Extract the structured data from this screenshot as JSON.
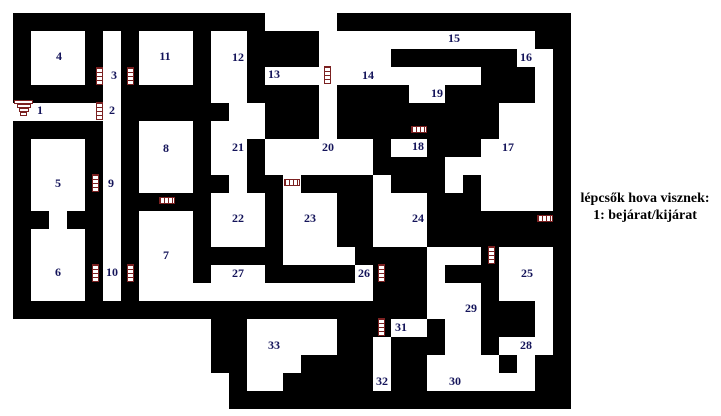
{
  "map": {
    "grid": {
      "origin_x": 13,
      "origin_y": 13,
      "cell": 18,
      "cols": 31,
      "rows": 22
    },
    "wall_color": "#000000",
    "floor_color": "#ffffff",
    "wall_rows": [
      "##############....#############",
      "#...#.#...#..####............##",
      "#...#.#...#..####....#######..#",
      "#...#.#...#..#............###.#",
      "#####.#####..####.####..#####.#",
      "......######..###.#########...#",
      "#####.#...#...###.#########...#",
      "#...#.#...#..#......#..###....#",
      "#...#.#...#..#......####......#",
      "#...#.#...##.##.####.###.#....#",
      "#...#.#####...#...##...###....#",
      "##.##.#...#...#...##...########",
      "#...#.#...#...#...##...########",
      "#...#.#...#####....####...#...#",
      "#...#.#...#...#####.###.###...#",
      "#...#.#.............###...#...#",
      "#######################...###.#",
      "...........##.....###..#..###.#",
      "...........##.....##.###..#...#",
      "...........##...####.##....#.##",
      "............#..#####.##......##",
      "............###################"
    ]
  },
  "label_color": "#14145a",
  "rooms": [
    {
      "label": "1",
      "x": 40,
      "y": 110
    },
    {
      "label": "2",
      "x": 112,
      "y": 110
    },
    {
      "label": "3",
      "x": 114,
      "y": 75
    },
    {
      "label": "4",
      "x": 59,
      "y": 56
    },
    {
      "label": "5",
      "x": 58,
      "y": 183
    },
    {
      "label": "6",
      "x": 58,
      "y": 272
    },
    {
      "label": "7",
      "x": 166,
      "y": 255
    },
    {
      "label": "8",
      "x": 166,
      "y": 148
    },
    {
      "label": "9",
      "x": 111,
      "y": 183
    },
    {
      "label": "10",
      "x": 112,
      "y": 272
    },
    {
      "label": "11",
      "x": 165,
      "y": 56
    },
    {
      "label": "12",
      "x": 238,
      "y": 57
    },
    {
      "label": "13",
      "x": 274,
      "y": 74
    },
    {
      "label": "14",
      "x": 368,
      "y": 75
    },
    {
      "label": "15",
      "x": 454,
      "y": 38
    },
    {
      "label": "16",
      "x": 526,
      "y": 57
    },
    {
      "label": "17",
      "x": 508,
      "y": 147
    },
    {
      "label": "18",
      "x": 418,
      "y": 146
    },
    {
      "label": "19",
      "x": 437,
      "y": 93
    },
    {
      "label": "20",
      "x": 328,
      "y": 147
    },
    {
      "label": "21",
      "x": 238,
      "y": 147
    },
    {
      "label": "22",
      "x": 238,
      "y": 218
    },
    {
      "label": "23",
      "x": 310,
      "y": 218
    },
    {
      "label": "24",
      "x": 418,
      "y": 218
    },
    {
      "label": "25",
      "x": 527,
      "y": 273
    },
    {
      "label": "26",
      "x": 364,
      "y": 273
    },
    {
      "label": "27",
      "x": 238,
      "y": 273
    },
    {
      "label": "28",
      "x": 526,
      "y": 345
    },
    {
      "label": "29",
      "x": 471,
      "y": 308
    },
    {
      "label": "30",
      "x": 455,
      "y": 381
    },
    {
      "label": "31",
      "x": 401,
      "y": 327
    },
    {
      "label": "32",
      "x": 382,
      "y": 381
    },
    {
      "label": "33",
      "x": 274,
      "y": 345
    }
  ],
  "stairs": {
    "color": "#7b2121",
    "ladders": [
      {
        "x": 96,
        "y": 67,
        "dir": "v"
      },
      {
        "x": 127,
        "y": 67,
        "dir": "v"
      },
      {
        "x": 96,
        "y": 102,
        "dir": "v"
      },
      {
        "x": 92,
        "y": 174,
        "dir": "v"
      },
      {
        "x": 92,
        "y": 264,
        "dir": "v"
      },
      {
        "x": 127,
        "y": 264,
        "dir": "v"
      },
      {
        "x": 324,
        "y": 66,
        "dir": "v"
      },
      {
        "x": 488,
        "y": 246,
        "dir": "v"
      },
      {
        "x": 378,
        "y": 264,
        "dir": "v"
      },
      {
        "x": 378,
        "y": 318,
        "dir": "v"
      },
      {
        "x": 159,
        "y": 197,
        "dir": "h"
      },
      {
        "x": 284,
        "y": 179,
        "dir": "h"
      },
      {
        "x": 411,
        "y": 126,
        "dir": "h"
      },
      {
        "x": 537,
        "y": 215,
        "dir": "h"
      }
    ],
    "entrance_icon": {
      "x": 14,
      "y": 100,
      "bar_widths": [
        19,
        14,
        10,
        7
      ]
    }
  },
  "legend": {
    "line1": "lépcsők hova visznek:",
    "line2": "1: bejárat/kijárat"
  }
}
